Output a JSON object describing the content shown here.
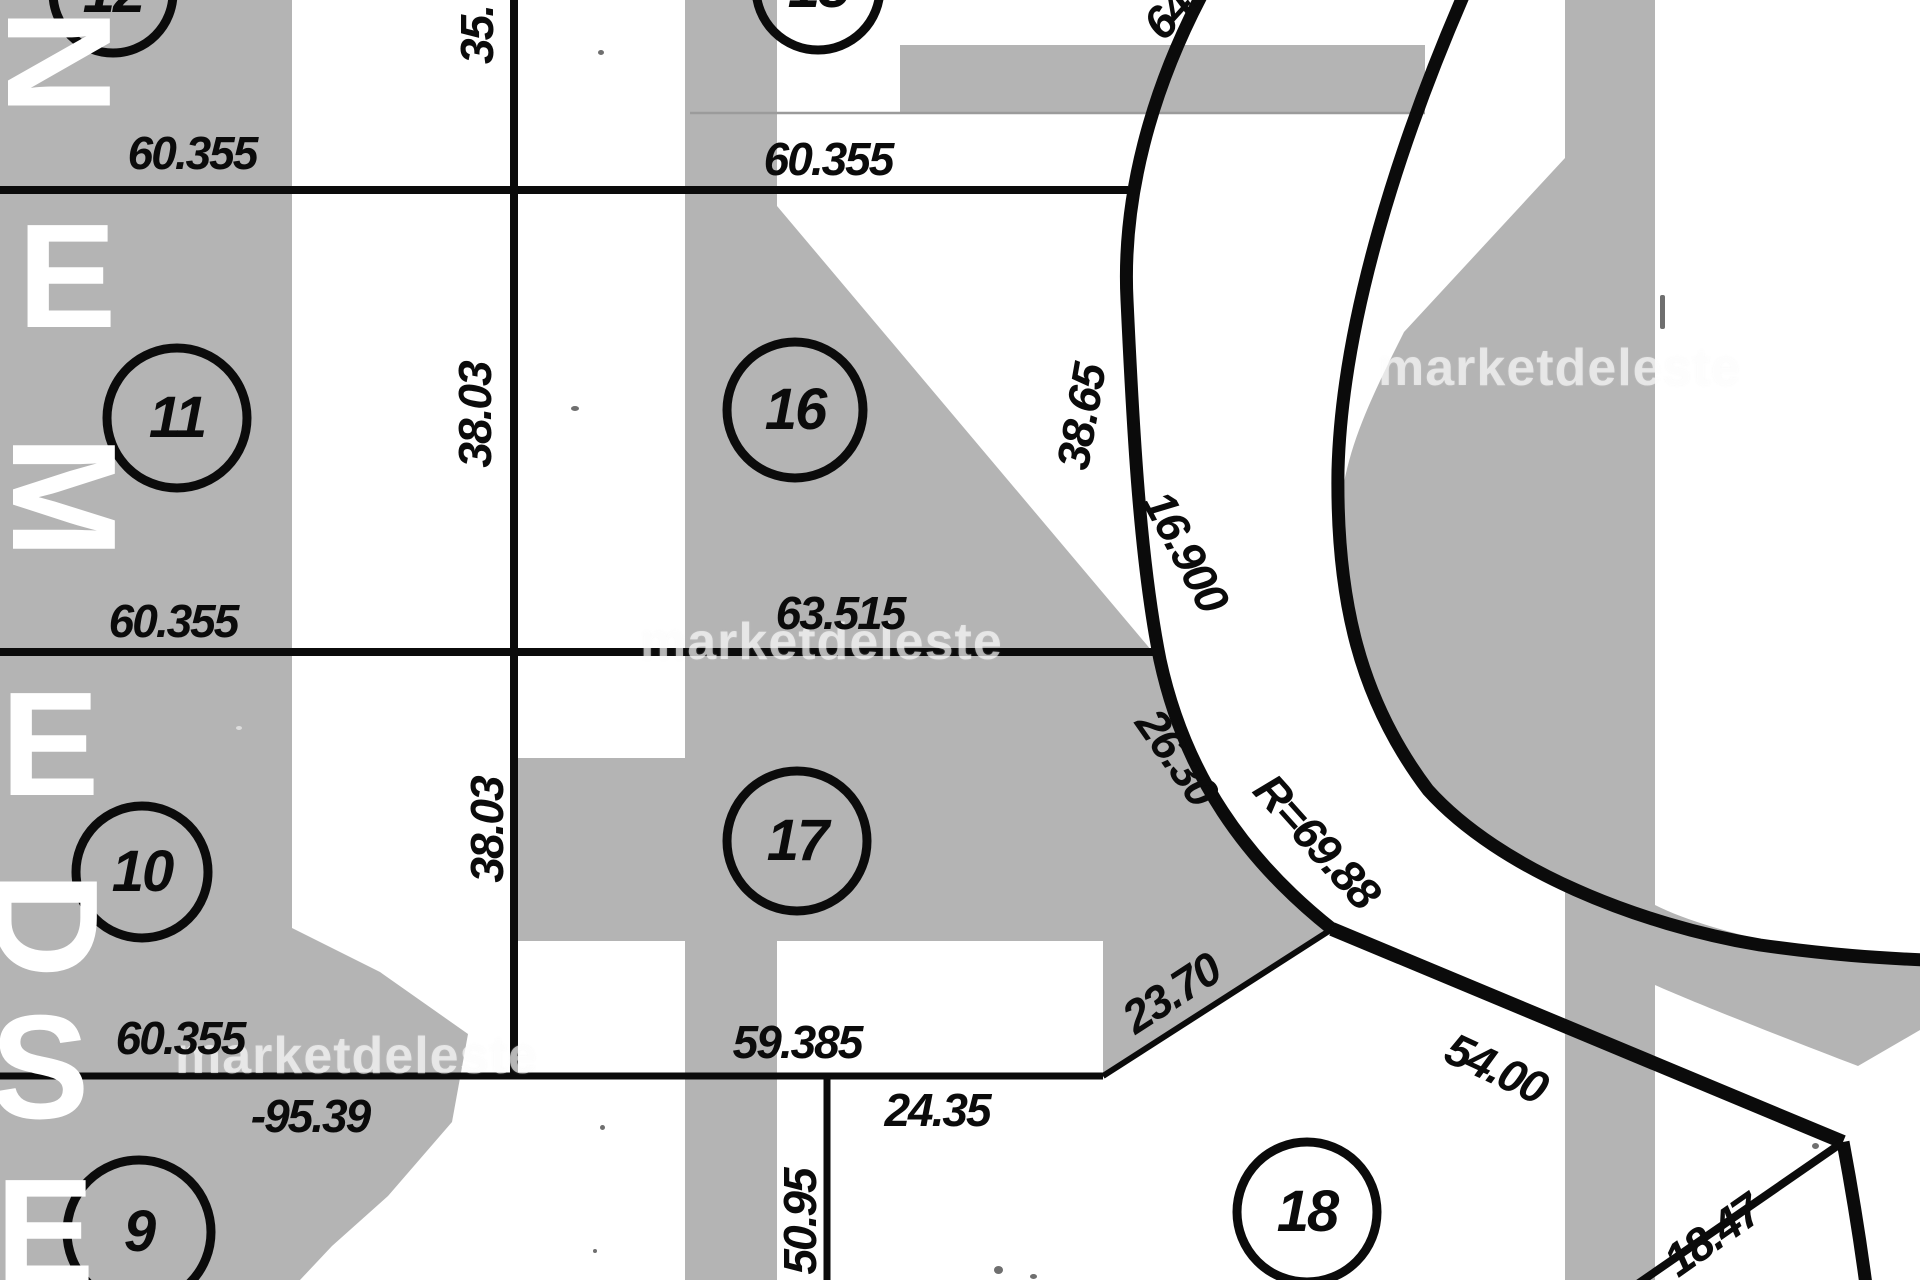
{
  "map": {
    "kind": "cadastral plat scan",
    "colors": {
      "mass_gray": "#b4b4b4",
      "ink": "#0b0b0b",
      "paper": "#ffffff"
    },
    "watermark": {
      "text": "marketdeleste"
    },
    "street_letters": [
      {
        "ch": "N"
      },
      {
        "ch": "E"
      },
      {
        "ch": "M"
      },
      {
        "ch": "E"
      },
      {
        "ch": "D"
      },
      {
        "ch": "S"
      },
      {
        "ch": "E"
      }
    ],
    "lots": [
      {
        "number": "12"
      },
      {
        "number": "15"
      },
      {
        "number": "11"
      },
      {
        "number": "16"
      },
      {
        "number": "10"
      },
      {
        "number": "17"
      },
      {
        "number": "9"
      },
      {
        "number": "18"
      }
    ],
    "dimensions": [
      {
        "value": "60.355"
      },
      {
        "value": "60.355"
      },
      {
        "value": "35."
      },
      {
        "value": "38.03"
      },
      {
        "value": "64.05"
      },
      {
        "value": "38.65"
      },
      {
        "value": "16.900"
      },
      {
        "value": "63.515"
      },
      {
        "value": "60.355"
      },
      {
        "value": "26.30"
      },
      {
        "value": "R=69.88"
      },
      {
        "value": "38.03"
      },
      {
        "value": "23.70"
      },
      {
        "value": "59.385"
      },
      {
        "value": "60.355"
      },
      {
        "value": "-95.39"
      },
      {
        "value": "24.35"
      },
      {
        "value": "50.95"
      },
      {
        "value": "54.00"
      },
      {
        "value": "18.47"
      }
    ]
  }
}
